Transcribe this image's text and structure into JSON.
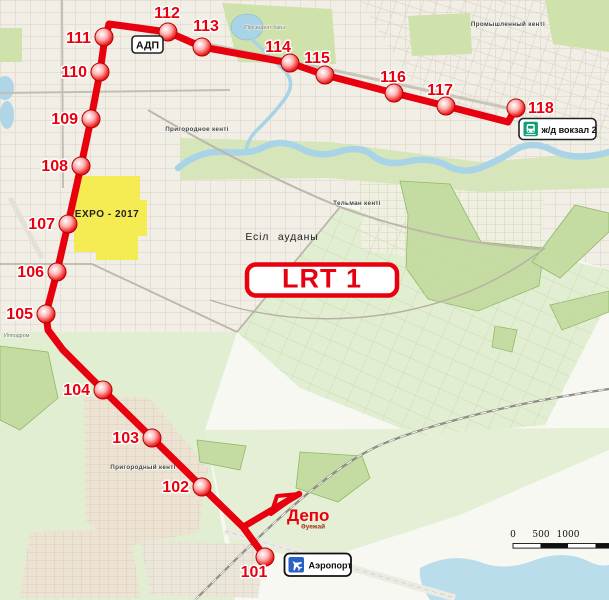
{
  "route_badge": "LRT 1",
  "stations": [
    "101",
    "102",
    "103",
    "104",
    "105",
    "106",
    "107",
    "108",
    "109",
    "110",
    "111",
    "112",
    "113",
    "114",
    "115",
    "116",
    "117",
    "118"
  ],
  "badges": {
    "adp": "АДП",
    "railway_station": "ж/д вокзал 2",
    "airport": "Аэропорт"
  },
  "labels": {
    "depot": "Депо",
    "depot_sub": "Әуежай",
    "expo": "EXPO - 2017"
  },
  "districts": {
    "esil": "Есіл ауданы",
    "telman": "Тельман кенті",
    "promyshlenny": "Промышленный кенті",
    "prigorodnoye": "Пригородное кенті",
    "prigorodny": "Пригородный кенті",
    "president_park": "Президент бағы",
    "hippodrome": "Ипподром"
  },
  "scale_bar": {
    "tick0": "0",
    "tick500": "500",
    "tick1000": "1000"
  },
  "colors": {
    "route": "#e8000f",
    "expo_area": "#f4ec3e",
    "railway_icon": "#0fa076",
    "airport_icon": "#2a62c4"
  }
}
